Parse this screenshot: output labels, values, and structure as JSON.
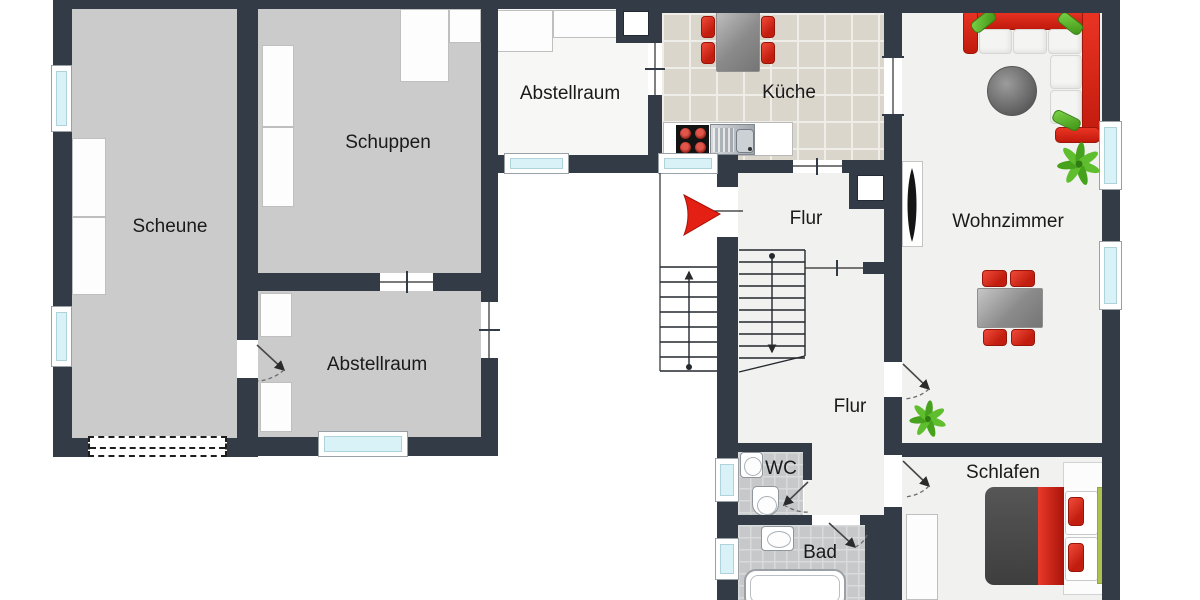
{
  "colors": {
    "wall": "#323b46",
    "room_gray": "#cbcbcb",
    "room_light": "#f1f1ef",
    "room_white": "#f7f7f6",
    "kitchen_tile": "#dad6cc",
    "bath_tile": "#c6c8ca",
    "window_glass": "#d9f2f7",
    "accent_red": "#e32017",
    "plant_green": "#46a11c",
    "label_color": "#1a1a1a"
  },
  "room_labels": [
    {
      "id": "scheune",
      "text": "Scheune",
      "x": 170,
      "y": 227
    },
    {
      "id": "schuppen",
      "text": "Schuppen",
      "x": 388,
      "y": 143
    },
    {
      "id": "abstellraum-top",
      "text": "Abstellraum",
      "x": 570,
      "y": 94
    },
    {
      "id": "kueche",
      "text": "Küche",
      "x": 789,
      "y": 93
    },
    {
      "id": "flur-upper",
      "text": "Flur",
      "x": 806,
      "y": 219
    },
    {
      "id": "wohnzimmer",
      "text": "Wohnzimmer",
      "x": 1008,
      "y": 222
    },
    {
      "id": "abstellraum-bottom",
      "text": "Abstellraum",
      "x": 377,
      "y": 365
    },
    {
      "id": "flur-lower",
      "text": "Flur",
      "x": 850,
      "y": 407
    },
    {
      "id": "wc",
      "text": "WC",
      "x": 781,
      "y": 469
    },
    {
      "id": "bad",
      "text": "Bad",
      "x": 820,
      "y": 553
    },
    {
      "id": "schlafen",
      "text": "Schlafen",
      "x": 1003,
      "y": 473
    }
  ],
  "floors": [
    {
      "name": "scheune",
      "x": 72,
      "y": 9,
      "w": 165,
      "h": 429,
      "t": "gray"
    },
    {
      "name": "schuppen",
      "x": 258,
      "y": 9,
      "w": 223,
      "h": 264,
      "t": "gray"
    },
    {
      "name": "abstellraum-top",
      "x": 496,
      "y": 9,
      "w": 152,
      "h": 146,
      "t": "white"
    },
    {
      "name": "abstellraum-bottom",
      "x": 258,
      "y": 291,
      "w": 223,
      "h": 146,
      "t": "gray"
    },
    {
      "name": "kueche",
      "x": 662,
      "y": 13,
      "w": 222,
      "h": 147,
      "t": "tiles-k"
    },
    {
      "name": "flur",
      "x": 738,
      "y": 173,
      "w": 146,
      "h": 270,
      "t": "light"
    },
    {
      "name": "flur-lower",
      "x": 804,
      "y": 443,
      "w": 80,
      "h": 72,
      "t": "light"
    },
    {
      "name": "wohnzimmer",
      "x": 902,
      "y": 13,
      "w": 200,
      "h": 430,
      "t": "light"
    },
    {
      "name": "schlafen",
      "x": 902,
      "y": 457,
      "w": 200,
      "h": 143,
      "t": "light"
    },
    {
      "name": "wc",
      "x": 738,
      "y": 452,
      "w": 65,
      "h": 63,
      "t": "tiles-b"
    },
    {
      "name": "bad",
      "x": 738,
      "y": 525,
      "w": 127,
      "h": 75,
      "t": "tiles-b"
    }
  ],
  "walls": [
    [
      53,
      0,
      609,
      9
    ],
    [
      648,
      0,
      472,
      13
    ],
    [
      53,
      9,
      19,
      58
    ],
    [
      53,
      130,
      19,
      178
    ],
    [
      53,
      365,
      19,
      92
    ],
    [
      53,
      438,
      35,
      19
    ],
    [
      227,
      438,
      31,
      19
    ],
    [
      237,
      9,
      21,
      331
    ],
    [
      237,
      378,
      21,
      79
    ],
    [
      481,
      9,
      17,
      293
    ],
    [
      481,
      358,
      17,
      98
    ],
    [
      258,
      273,
      122,
      18
    ],
    [
      433,
      273,
      48,
      18
    ],
    [
      258,
      437,
      62,
      19
    ],
    [
      406,
      437,
      92,
      19
    ],
    [
      488,
      155,
      20,
      18
    ],
    [
      563,
      155,
      100,
      18
    ],
    [
      717,
      155,
      21,
      32
    ],
    [
      648,
      9,
      14,
      34
    ],
    [
      648,
      95,
      14,
      63
    ],
    [
      884,
      13,
      18,
      44
    ],
    [
      884,
      115,
      18,
      45
    ],
    [
      1102,
      0,
      18,
      125
    ],
    [
      1102,
      188,
      18,
      57
    ],
    [
      1102,
      308,
      18,
      292
    ],
    [
      717,
      237,
      21,
      226
    ],
    [
      717,
      500,
      21,
      42
    ],
    [
      717,
      578,
      21,
      22
    ],
    [
      738,
      160,
      55,
      13
    ],
    [
      842,
      160,
      42,
      13
    ],
    [
      884,
      160,
      18,
      103
    ],
    [
      884,
      263,
      18,
      99
    ],
    [
      884,
      397,
      18,
      58
    ],
    [
      884,
      507,
      18,
      93
    ],
    [
      863,
      262,
      21,
      12
    ],
    [
      902,
      443,
      200,
      14
    ],
    [
      738,
      443,
      66,
      9
    ],
    [
      803,
      443,
      9,
      37
    ],
    [
      738,
      515,
      74,
      10
    ],
    [
      860,
      515,
      25,
      10
    ],
    [
      865,
      525,
      37,
      75
    ]
  ],
  "windows": [
    {
      "x": 51,
      "y": 65,
      "w": 21,
      "h": 67,
      "o": "v"
    },
    {
      "x": 51,
      "y": 306,
      "w": 21,
      "h": 61,
      "o": "v"
    },
    {
      "x": 318,
      "y": 431,
      "w": 90,
      "h": 26,
      "o": "h"
    },
    {
      "x": 504,
      "y": 153,
      "w": 65,
      "h": 21,
      "o": "h"
    },
    {
      "x": 658,
      "y": 153,
      "w": 60,
      "h": 21,
      "o": "h"
    },
    {
      "x": 715,
      "y": 458,
      "w": 24,
      "h": 44,
      "o": "v"
    },
    {
      "x": 715,
      "y": 538,
      "w": 24,
      "h": 42,
      "o": "v"
    },
    {
      "x": 1099,
      "y": 121,
      "w": 23,
      "h": 69,
      "o": "v"
    },
    {
      "x": 1099,
      "y": 241,
      "w": 23,
      "h": 69,
      "o": "v"
    }
  ],
  "chimneys": [
    [
      616,
      0,
      40,
      43,
      623,
      11,
      26,
      25
    ],
    [
      849,
      167,
      44,
      42,
      857,
      175,
      27,
      26
    ]
  ],
  "storage_blocks": [
    [
      72,
      138,
      34,
      79
    ],
    [
      72,
      217,
      34,
      78
    ],
    [
      262,
      45,
      32,
      82
    ],
    [
      262,
      127,
      32,
      80
    ],
    [
      400,
      9,
      49,
      73
    ],
    [
      449,
      9,
      32,
      34
    ],
    [
      497,
      10,
      56,
      42
    ],
    [
      553,
      10,
      87,
      28
    ],
    [
      260,
      293,
      32,
      44
    ],
    [
      260,
      382,
      32,
      50
    ]
  ],
  "barn_gate": [
    88,
    436,
    139,
    21
  ],
  "furniture": [
    {
      "n": "kitchen-counter",
      "c": "counter",
      "r": [
        663,
        122,
        130,
        34
      ]
    },
    {
      "n": "stove",
      "c": "stove",
      "r": [
        676,
        125,
        33,
        31
      ]
    },
    {
      "n": "kitchen-sink",
      "c": "ksink",
      "r": [
        710,
        124,
        45,
        31
      ]
    },
    {
      "n": "kitchen-table",
      "c": "table-gray",
      "r": [
        716,
        4,
        44,
        68
      ]
    },
    {
      "n": "kitchen-chair",
      "c": "chair-red",
      "r": [
        701,
        16,
        14,
        22
      ]
    },
    {
      "n": "kitchen-chair",
      "c": "chair-red",
      "r": [
        701,
        42,
        14,
        22
      ]
    },
    {
      "n": "kitchen-chair",
      "c": "chair-red",
      "r": [
        761,
        16,
        14,
        22
      ]
    },
    {
      "n": "kitchen-chair",
      "c": "chair-red",
      "r": [
        761,
        42,
        14,
        22
      ]
    },
    {
      "n": "sofa-back",
      "c": "sofa-red",
      "r": [
        963,
        10,
        137,
        20
      ]
    },
    {
      "n": "sofa-back",
      "c": "sofa-red",
      "r": [
        1082,
        10,
        18,
        133
      ]
    },
    {
      "n": "sofa-arm",
      "c": "sofa-red",
      "r": [
        963,
        10,
        15,
        44
      ]
    },
    {
      "n": "sofa-arm",
      "c": "sofa-red",
      "r": [
        1055,
        127,
        45,
        16
      ]
    },
    {
      "n": "sofa-cushion",
      "c": "cushion",
      "r": [
        979,
        29,
        33,
        25
      ]
    },
    {
      "n": "sofa-cushion",
      "c": "cushion",
      "r": [
        1013,
        29,
        34,
        25
      ]
    },
    {
      "n": "sofa-cushion",
      "c": "cushion",
      "r": [
        1048,
        29,
        34,
        25
      ]
    },
    {
      "n": "sofa-cushion",
      "c": "cushion",
      "r": [
        1050,
        55,
        32,
        34
      ]
    },
    {
      "n": "sofa-cushion",
      "c": "cushion",
      "r": [
        1050,
        90,
        32,
        34
      ]
    },
    {
      "n": "sofa-pillow",
      "c": "pillow-green",
      "r": [
        970,
        15,
        27,
        13
      ],
      "rot": -38
    },
    {
      "n": "sofa-pillow",
      "c": "pillow-green",
      "r": [
        1057,
        17,
        27,
        13
      ],
      "rot": 38
    },
    {
      "n": "sofa-pillow",
      "c": "pillow-green",
      "r": [
        1052,
        114,
        29,
        13
      ],
      "rot": 26
    },
    {
      "n": "coffee-table",
      "c": "round-table",
      "r": [
        987,
        66,
        50,
        50
      ]
    },
    {
      "n": "dining-table",
      "c": "table-gray",
      "r": [
        977,
        288,
        66,
        40
      ]
    },
    {
      "n": "dining-chair",
      "c": "chair-red",
      "r": [
        982,
        270,
        25,
        17
      ]
    },
    {
      "n": "dining-chair",
      "c": "chair-red",
      "r": [
        1010,
        270,
        25,
        17
      ]
    },
    {
      "n": "dining-chair",
      "c": "chair-red",
      "r": [
        983,
        329,
        24,
        17
      ]
    },
    {
      "n": "dining-chair",
      "c": "chair-red",
      "r": [
        1011,
        329,
        24,
        17
      ]
    },
    {
      "n": "wood-stove-panel",
      "c": "panel",
      "r": [
        902,
        161,
        21,
        86
      ]
    },
    {
      "n": "bed-frame",
      "c": "bedframe",
      "r": [
        1063,
        462,
        40,
        133
      ]
    },
    {
      "n": "bed-duvet",
      "c": "duvet",
      "r": [
        985,
        487,
        55,
        98
      ]
    },
    {
      "n": "bed-stripe",
      "c": "bedstripe",
      "r": [
        1038,
        487,
        26,
        98
      ]
    },
    {
      "n": "bed-pillow",
      "c": "bedpillow",
      "r": [
        1065,
        491,
        33,
        44
      ]
    },
    {
      "n": "bed-pillow",
      "c": "bedpillow",
      "r": [
        1065,
        537,
        33,
        44
      ]
    },
    {
      "n": "bed-cushion",
      "c": "chair-red",
      "r": [
        1068,
        497,
        16,
        29
      ]
    },
    {
      "n": "bed-cushion",
      "c": "chair-red",
      "r": [
        1068,
        543,
        16,
        29
      ]
    },
    {
      "n": "bed-board",
      "c": "greenboard",
      "r": [
        1097,
        487,
        7,
        97
      ]
    },
    {
      "n": "wardrobe",
      "c": "block",
      "r": [
        906,
        514,
        32,
        86
      ]
    },
    {
      "n": "wc-sink",
      "c": "fixture",
      "r": [
        740,
        452,
        23,
        26
      ]
    },
    {
      "n": "toilet",
      "c": "fixture toilet",
      "r": [
        752,
        486,
        27,
        30
      ]
    },
    {
      "n": "bath-sink",
      "c": "fixture",
      "r": [
        761,
        526,
        33,
        25
      ]
    },
    {
      "n": "bathtub",
      "c": "tub",
      "r": [
        744,
        569,
        102,
        40
      ]
    }
  ],
  "stairs": [
    {
      "name": "exterior-staircase",
      "x1": 660,
      "x2": 717,
      "ys": [
        267,
        282,
        297,
        312,
        327,
        342,
        357,
        371
      ],
      "cx": 689,
      "cy1": 367,
      "cy2": 272,
      "dot": [
        689,
        367
      ]
    },
    {
      "name": "interior-staircase",
      "x1": 739,
      "x2": 805,
      "ys": [
        250,
        262,
        274,
        286,
        298,
        310,
        322,
        334,
        346,
        358
      ],
      "cx": 772,
      "cy1": 256,
      "cy2": 352,
      "dot": [
        772,
        256
      ],
      "edge": [
        805,
        250,
        805,
        356
      ],
      "diag": [
        739,
        372,
        805,
        356
      ]
    }
  ],
  "openings": [
    {
      "l": [
        655,
        43,
        655,
        95
      ],
      "t": [
        [
          645,
          69,
          665,
          69
        ]
      ]
    },
    {
      "l": [
        793,
        166,
        842,
        166
      ],
      "t": [
        [
          817,
          158,
          817,
          175
        ]
      ]
    },
    {
      "l": [
        380,
        282,
        433,
        282
      ],
      "t": [
        [
          407,
          271,
          407,
          293
        ]
      ]
    },
    {
      "l": [
        489,
        302,
        489,
        358
      ],
      "t": [
        [
          479,
          330,
          500,
          330
        ]
      ]
    },
    {
      "l": [
        805,
        268,
        863,
        268
      ],
      "t": [
        [
          837,
          260,
          837,
          276
        ]
      ]
    },
    {
      "l": [
        893,
        57,
        893,
        115
      ],
      "t": [
        [
          882,
          57,
          904,
          57
        ],
        [
          882,
          115,
          904,
          115
        ]
      ]
    },
    {
      "l": [
        713,
        211,
        743,
        211
      ],
      "t": []
    }
  ],
  "doors": [
    {
      "leaf": [
        257,
        345,
        284,
        370
      ],
      "arc": "M284,370 Q272,380 258,381"
    },
    {
      "leaf": [
        903,
        364,
        929,
        389
      ],
      "arc": "M929,389 Q919,398 904,399"
    },
    {
      "leaf": [
        903,
        461,
        929,
        486
      ],
      "arc": "M929,486 Q919,496 904,497"
    },
    {
      "leaf": [
        808,
        482,
        784,
        505
      ],
      "arc": "M784,505 Q797,513 809,512"
    },
    {
      "leaf": [
        829,
        523,
        855,
        547
      ],
      "arc": "M855,547 Q863,544 867,535"
    }
  ],
  "entrance_arrow": "M684,195 L720,214 L684,235 Q692,215 684,195 Z",
  "wood_stove_blade": "M912,168 C918,186 918,223 912,242 C906,223 906,186 912,168 Z",
  "porch_edge": [
    660,
    173,
    660,
    371
  ],
  "plants": [
    {
      "cx": 1079,
      "cy": 164,
      "s": 1
    },
    {
      "cx": 928,
      "cy": 419,
      "s": 0.85
    }
  ]
}
